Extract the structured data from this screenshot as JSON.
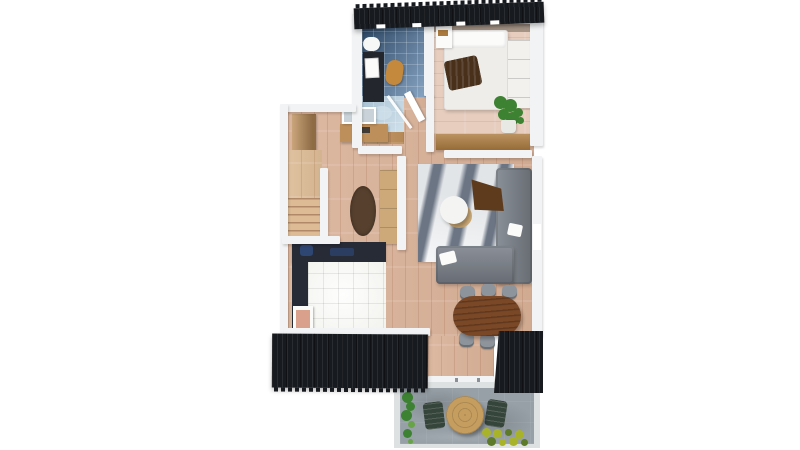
{
  "scene": {
    "type": "3d-floor-plan-render",
    "view": "top-down isometric",
    "background": "#ffffff"
  },
  "palette": {
    "white": "#ffffff",
    "wall": "#f1f3f4",
    "roof": "#171a1f",
    "woodFloor": "#d9b197",
    "bedroomFloor": "#e7cdbe",
    "headboard": "#998a7c",
    "bathTileDark": "#2c4865",
    "bathTileLight": "#84a0bf",
    "wetFloor": "#a9c2d4",
    "showerGlass": "#cfe0ea",
    "toiletWhite": "#f6f7f7",
    "vanityDark": "#23262c",
    "stoolOrange": "#c5893d",
    "bedWhite": "#efedea",
    "pillowWhite": "#fbfbfa",
    "blanketBrown": "#48301a",
    "dresserWhite": "#f2f1ee",
    "plantGreen": "#3d8132",
    "plantLight": "#67a447",
    "pot": "#e8e8e5",
    "ledgeWood": "#ab7a3e",
    "furnitureWood": "#bd8f5b",
    "cabinetWood": "#cda97a",
    "stairsWood": "#dcbb95",
    "mirrorGlass": "#c8d2d8",
    "rugBrown": "#57402e",
    "rugLight": "#e2e5e8",
    "rugDark": "#6b7584",
    "sofaGray": "#7e848d",
    "throwBrown": "#5e3b1d",
    "coffeeWhite": "#f4f4f2",
    "coffeeTan": "#c9a36a",
    "counterDark": "#262b36",
    "kettleNavy": "#2e4672",
    "kitchenTile": "#f3f3ef",
    "artPink": "#d9a08c",
    "diningWood": "#7a4827",
    "chairGray": "#8e949b",
    "patioBorder": "#dee1e1",
    "patioStone": "#97a0a7",
    "patioTable": "#c49d5f",
    "patioChair": "#36453c",
    "shrubYellow": "#a9b32a",
    "shrubGreen": "#5c7a2a"
  },
  "rooms": [
    {
      "name": "bathroom",
      "furniture": [
        "toilet",
        "vanity",
        "art-print",
        "stool",
        "walk-in-shower",
        "bench"
      ]
    },
    {
      "name": "bedroom",
      "furniture": [
        "double-bed",
        "throw-blanket",
        "dresser",
        "wall-shelf",
        "potted-plant"
      ]
    },
    {
      "name": "hallway",
      "furniture": [
        "wardrobe",
        "mirror",
        "console-table",
        "staircase",
        "runner-rug",
        "tall-cabinet"
      ]
    },
    {
      "name": "living-room",
      "furniture": [
        "sectional-sofa",
        "coffee-table",
        "area-rug",
        "throw-blanket",
        "cushions"
      ]
    },
    {
      "name": "kitchen",
      "furniture": [
        "l-shaped-counter",
        "counter-items",
        "tiled-floor",
        "picture-frame"
      ]
    },
    {
      "name": "dining-area",
      "furniture": [
        "oval-table"
      ],
      "chair_count": 6
    },
    {
      "name": "patio",
      "furniture": [
        "round-table",
        "tall-plant",
        "flower-bed"
      ],
      "chair_count": 2
    }
  ],
  "exterior": {
    "roofs": [
      "top-roof",
      "left-balcony-roof",
      "right-balcony-roof"
    ],
    "patio_surface": "stone-paving"
  }
}
